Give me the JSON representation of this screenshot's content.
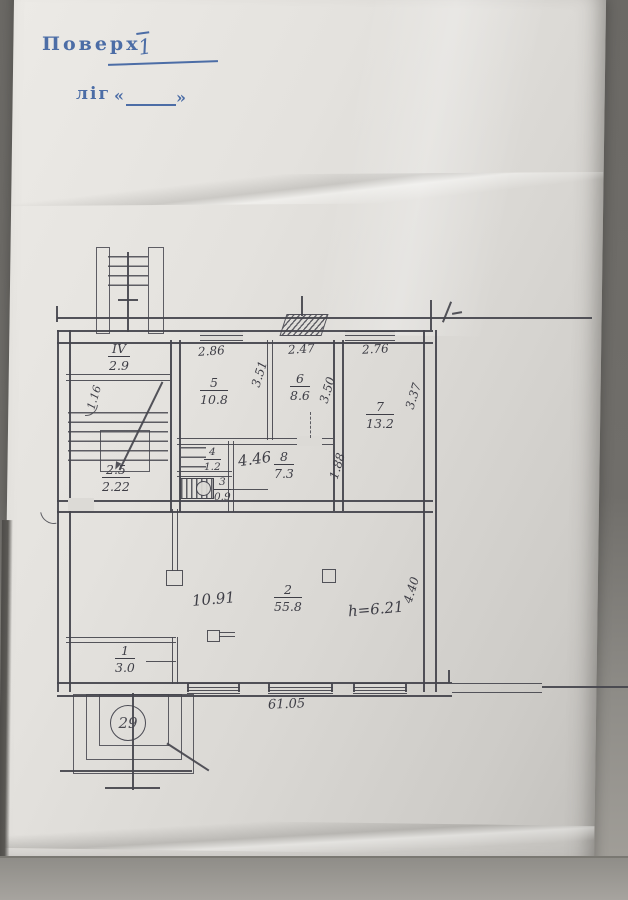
{
  "stamp": {
    "floor_label": "Поверх",
    "floor_value": "1",
    "letter_label": "ліг",
    "quote_open": "«",
    "quote_close": "»"
  },
  "plan": {
    "total_width": "61.05",
    "entrance_number": "29",
    "stair": {
      "num": "IV",
      "area": "2.9",
      "side": "1.16",
      "landing": "2.5",
      "width": "2.22"
    },
    "rooms": {
      "r1": {
        "num": "1",
        "area": "3.0"
      },
      "r2": {
        "num": "2",
        "area": "55.8",
        "width": "10.91",
        "height_note": "h=6.21",
        "side": "4.40"
      },
      "r3": {
        "num": "3",
        "area": "0.9"
      },
      "r4": {
        "num": "4",
        "area": "1.2"
      },
      "r5": {
        "num": "5",
        "area": "10.8",
        "width": "2.86",
        "side": "3.51"
      },
      "r6": {
        "num": "6",
        "area": "8.6",
        "width": "2.47",
        "side": "3.50"
      },
      "r7": {
        "num": "7",
        "area": "13.2",
        "width": "2.76",
        "side": "3.37"
      },
      "r8": {
        "num": "8",
        "area": "7.3",
        "width": "4.46",
        "side": "1.88"
      }
    }
  },
  "colors": {
    "stamp_blue": "#4c6da6",
    "ink": "#45454d",
    "paper": "#dcdad6"
  }
}
